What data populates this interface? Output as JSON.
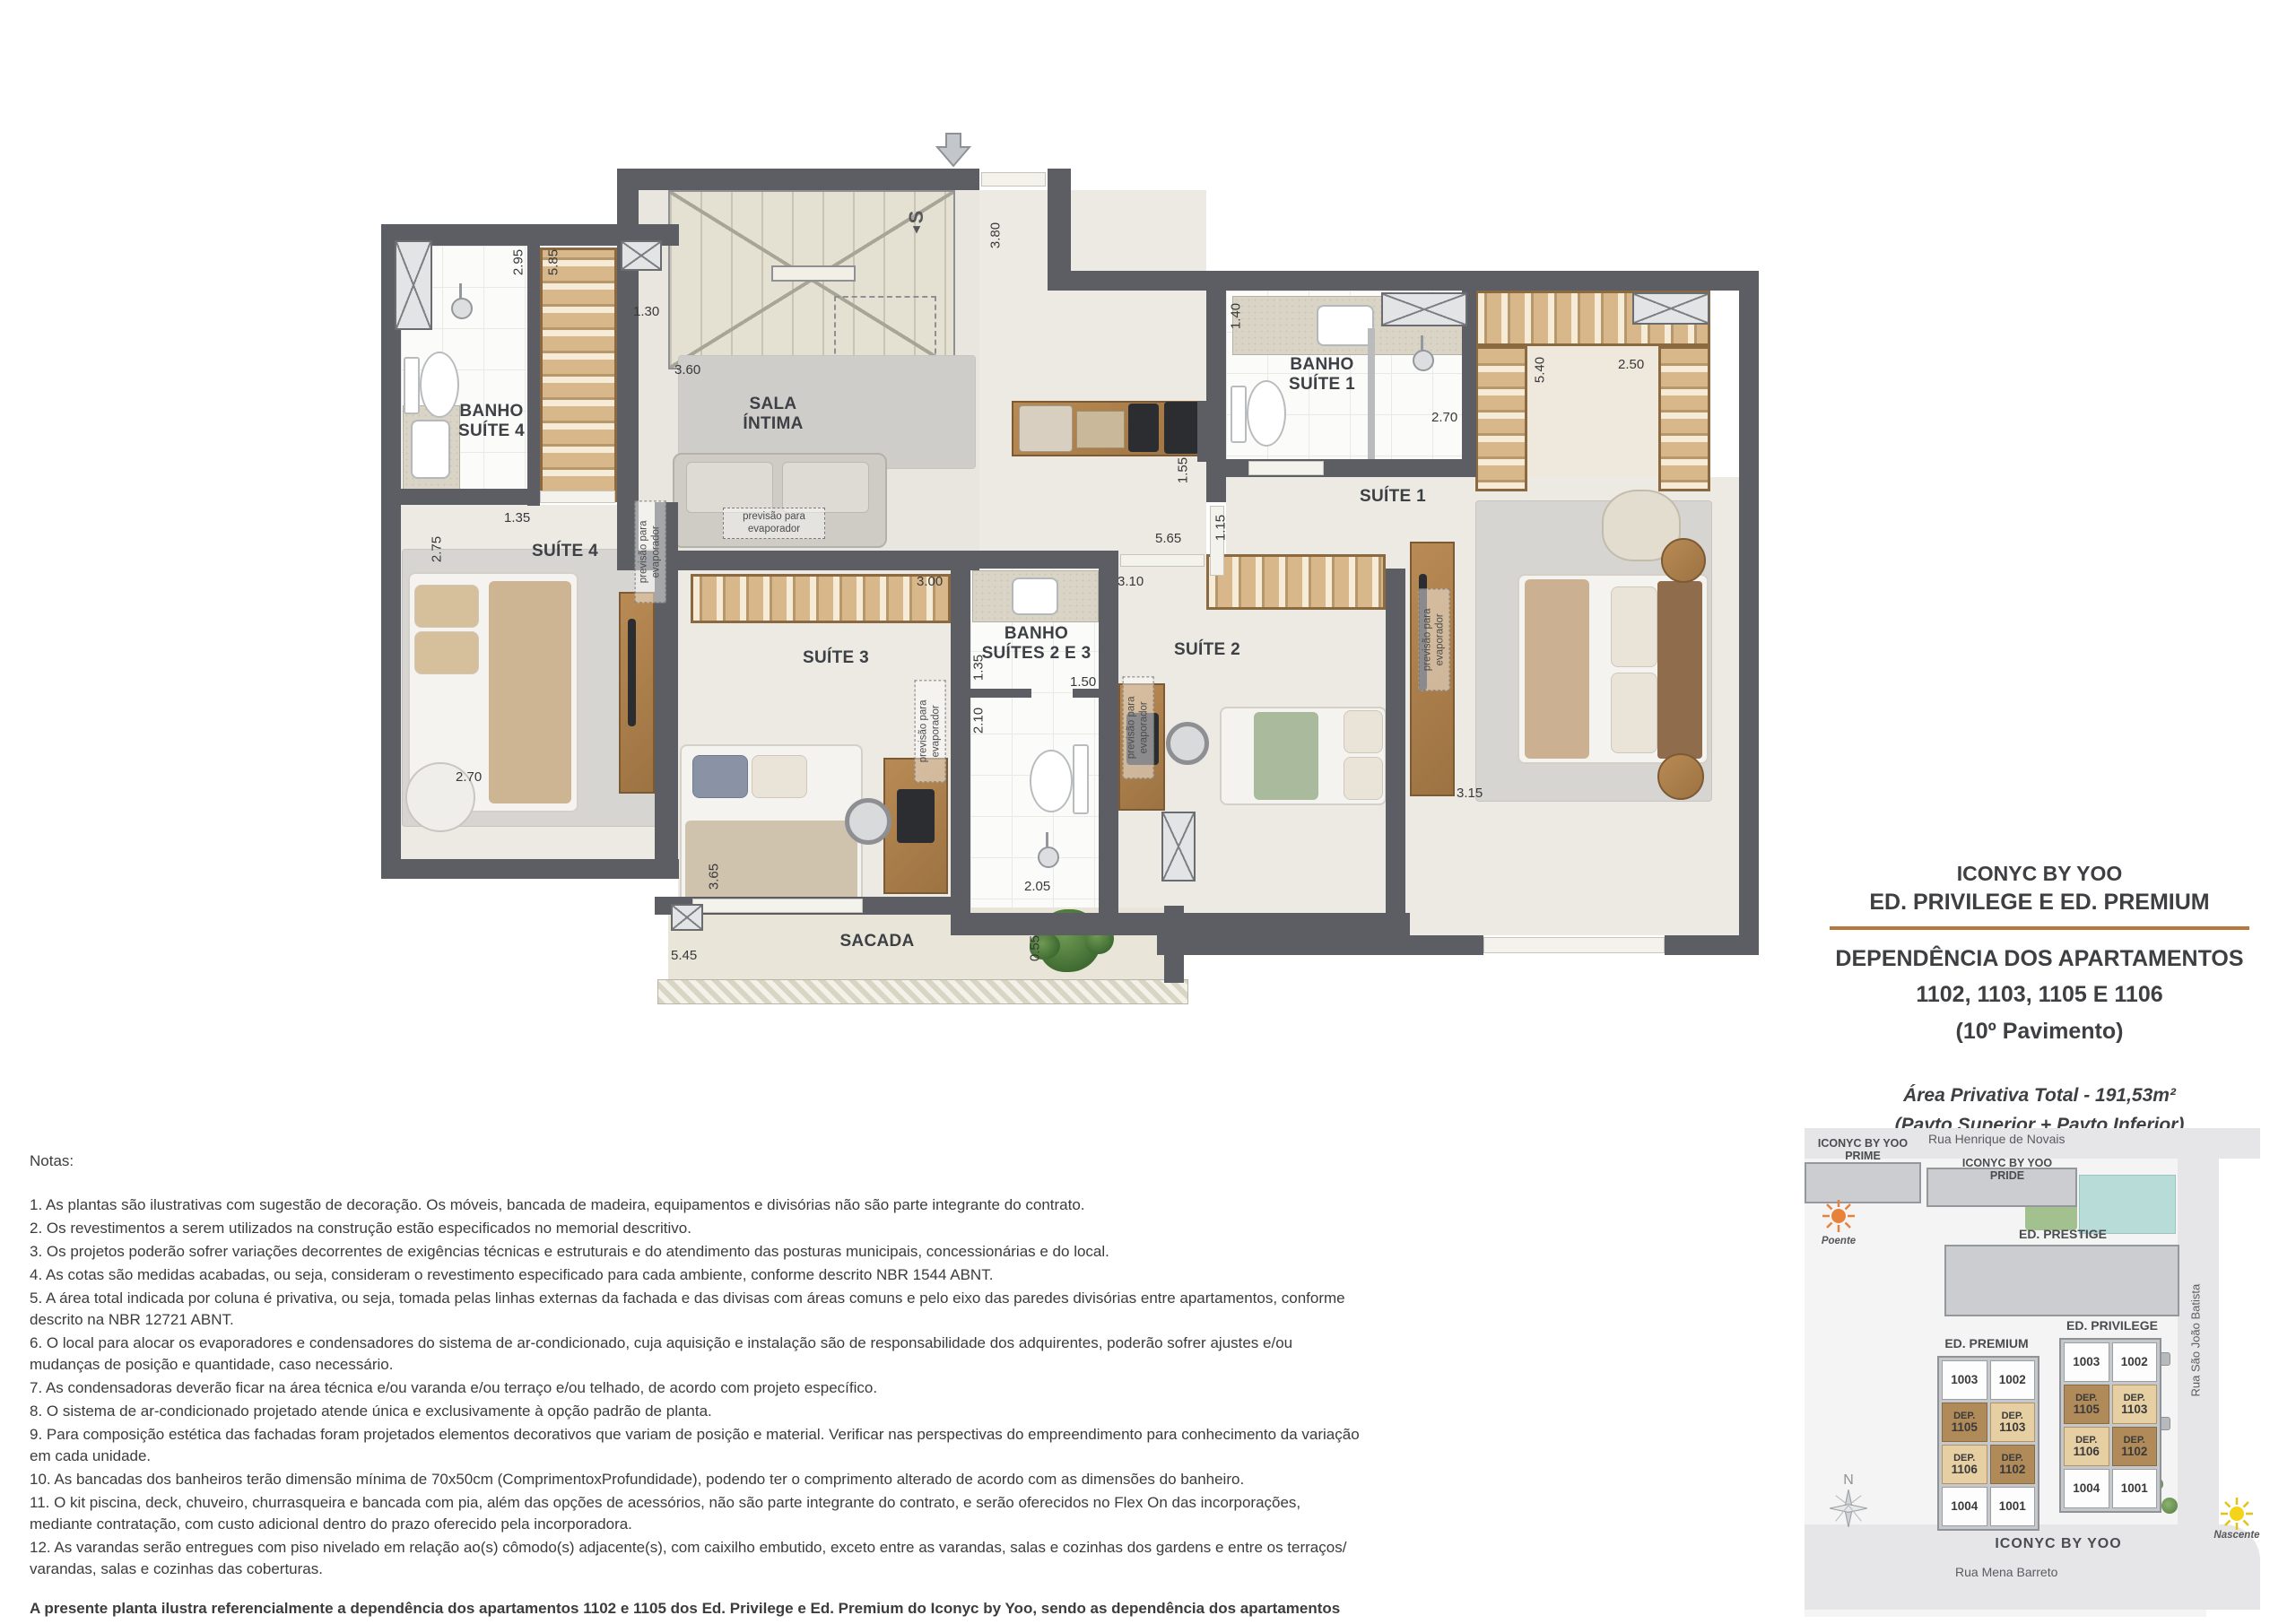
{
  "plan": {
    "entry": {
      "stair_direction": "S"
    },
    "rooms": {
      "banho_suite4": "BANHO\nSUÍTE 4",
      "suite4": "SUÍTE 4",
      "sala_intima": "SALA\nÍNTIMA",
      "banho_suite1": "BANHO\nSUÍTE 1",
      "suite1": "SUÍTE 1",
      "suite3": "SUÍTE 3",
      "banho_suites_2_3": "BANHO\nSUÍTES 2 E 3",
      "suite2": "SUÍTE 2",
      "sacada": "SACADA"
    },
    "evaporator_note": "previsão para\nevaporador",
    "dims": {
      "d295": "2.95",
      "d585": "5.85",
      "d130": "1.30",
      "d135a": "1.35",
      "d275": "2.75",
      "d270a": "2.70",
      "d380": "3.80",
      "d360": "3.60",
      "d300": "3.00",
      "d155": "1.55",
      "d565": "5.65",
      "d115": "1.15",
      "d310": "3.10",
      "d140": "1.40",
      "d270b": "2.70",
      "d540": "5.40",
      "d250": "2.50",
      "d315": "3.15",
      "d135b": "1.35",
      "d150": "1.50",
      "d210": "2.10",
      "d205": "2.05",
      "d365": "3.65",
      "d545": "5.45",
      "d055": "0.55"
    }
  },
  "title_block": {
    "project": "ICONYC BY YOO",
    "buildings": "ED. PRIVILEGE E ED. PREMIUM",
    "dependency": "DEPENDÊNCIA DOS APARTAMENTOS",
    "apartments": "1102, 1103, 1105 E 1106",
    "floor": "(10º Pavimento)",
    "area": "Área Privativa Total - 191,53m²",
    "area_note": "(Pavto Superior + Pavto Inferior)"
  },
  "notes": {
    "heading": "Notas:",
    "items": [
      "1. As plantas são ilustrativas com sugestão de decoração. Os móveis, bancada de madeira, equipamentos e divisórias não são parte integrante do contrato.",
      "2. Os revestimentos a serem utilizados na construção estão especificados no memorial descritivo.",
      "3. Os projetos poderão sofrer variações decorrentes de exigências técnicas e estruturais e do atendimento das posturas municipais, concessionárias e do local.",
      "4. As cotas são medidas acabadas, ou seja, consideram o revestimento especificado para cada ambiente, conforme descrito NBR 1544 ABNT.",
      "5. A área total indicada por coluna é privativa, ou seja, tomada pelas linhas externas da fachada e das divisas com áreas comuns e pelo eixo das paredes divisórias entre apartamentos, conforme descrito na NBR 12721 ABNT.",
      "6. O local para alocar os evaporadores e condensadores do sistema de ar-condicionado, cuja aquisição e instalação são de responsabilidade dos adquirentes, poderão sofrer ajustes e/ou mudanças de posição e quantidade, caso necessário.",
      "7. As condensadoras deverão ficar na área técnica e/ou varanda e/ou terraço e/ou telhado, de acordo com projeto específico.",
      "8. O sistema de ar-condicionado projetado atende única e exclusivamente à opção padrão de planta.",
      "9. Para composição estética das fachadas foram projetados elementos decorativos que variam de posição e material. Verificar nas perspectivas do empreendimento para conhecimento da variação em cada unidade.",
      "10. As bancadas dos banheiros terão dimensão mínima de 70x50cm (ComprimentoxProfundidade), podendo ter o comprimento alterado de acordo com as dimensões do banheiro.",
      "11. O kit piscina, deck, chuveiro, churrasqueira e bancada com pia, além das opções de acessórios, não são parte integrante do contrato, e serão oferecidos no Flex On das incorporações, mediante contratação, com custo adicional dentro do prazo oferecido pela incorporadora.",
      "12. As varandas serão entregues com piso nivelado em relação ao(s) cômodo(s) adjacente(s), com caixilho embutido, exceto entre as varandas, salas e cozinhas dos gardens e entre os terraços/ varandas, salas e cozinhas das coberturas."
    ],
    "footer": "A presente planta ilustra referencialmente a dependência dos apartamentos 1102 e 1105 dos Ed. Privilege e Ed. Premium do Iconyc by Yoo, sendo as dependência dos apartamentos 1103 e 1106 dos Ed. Privilege e Ed. Premium do Iconyc by Yoo espelhados."
  },
  "sitemap": {
    "streets": {
      "top": "Rua Henrique de Novais",
      "right": "Rua São João Batista",
      "bottom": "Rua Mena Barreto"
    },
    "buildings": {
      "prime": "ICONYC BY YOO\nPRIME",
      "pride": "ICONYC BY YOO\nPRIDE",
      "prestige": "ED. PRESTIGE",
      "premium": "ED. PREMIUM",
      "privilege": "ED. PRIVILEGE",
      "complex": "ICONYC BY YOO"
    },
    "suns": {
      "west": "Poente",
      "east": "Nascente"
    },
    "compass": "N",
    "units": {
      "dep": "DEP.",
      "r1l": "1003",
      "r1r": "1002",
      "r2l": "1105",
      "r2r": "1103",
      "r3l": "1106",
      "r3r": "1102",
      "r4l": "1004",
      "r4r": "1001"
    }
  }
}
